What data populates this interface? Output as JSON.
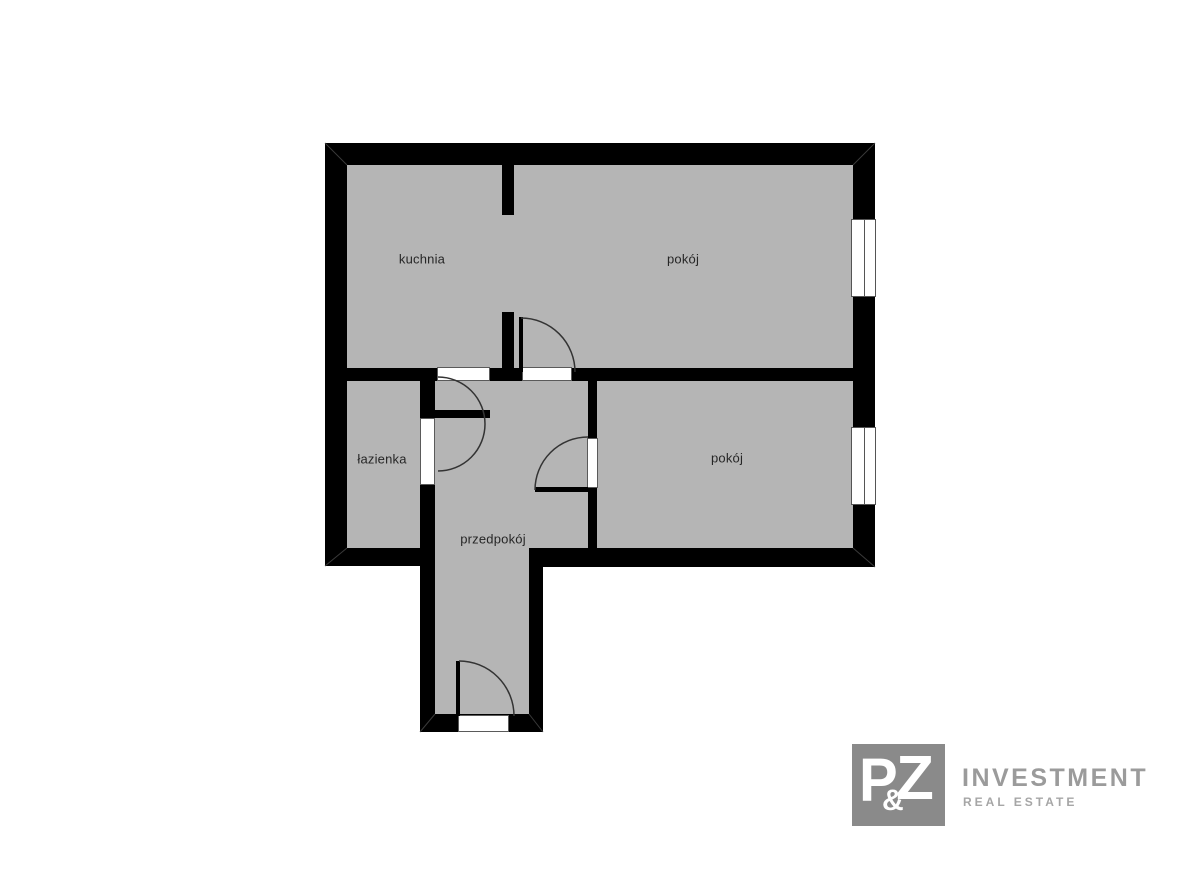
{
  "floor_plan": {
    "rooms": [
      {
        "id": "kuchnia",
        "label": "kuchnia"
      },
      {
        "id": "pokoj-gorny",
        "label": "pokój"
      },
      {
        "id": "lazienka",
        "label": "łazienka"
      },
      {
        "id": "pokoj-dolny",
        "label": "pokój"
      },
      {
        "id": "przedpokoj",
        "label": "przedpokój"
      }
    ],
    "colors": {
      "floor": "#b5b5b5",
      "wall": "#000000",
      "background": "#ffffff",
      "label_text": "#262626"
    }
  },
  "logo": {
    "monogram": {
      "letter_p": "P",
      "ampersand": "&",
      "letter_z": "Z"
    },
    "name": "INVESTMENT",
    "tagline": "REAL ESTATE",
    "colors": {
      "square": "#8a8a8a",
      "monogram_text": "#ffffff",
      "name_text": "#9b9b9b",
      "tagline_text": "#a6a6a6"
    }
  }
}
